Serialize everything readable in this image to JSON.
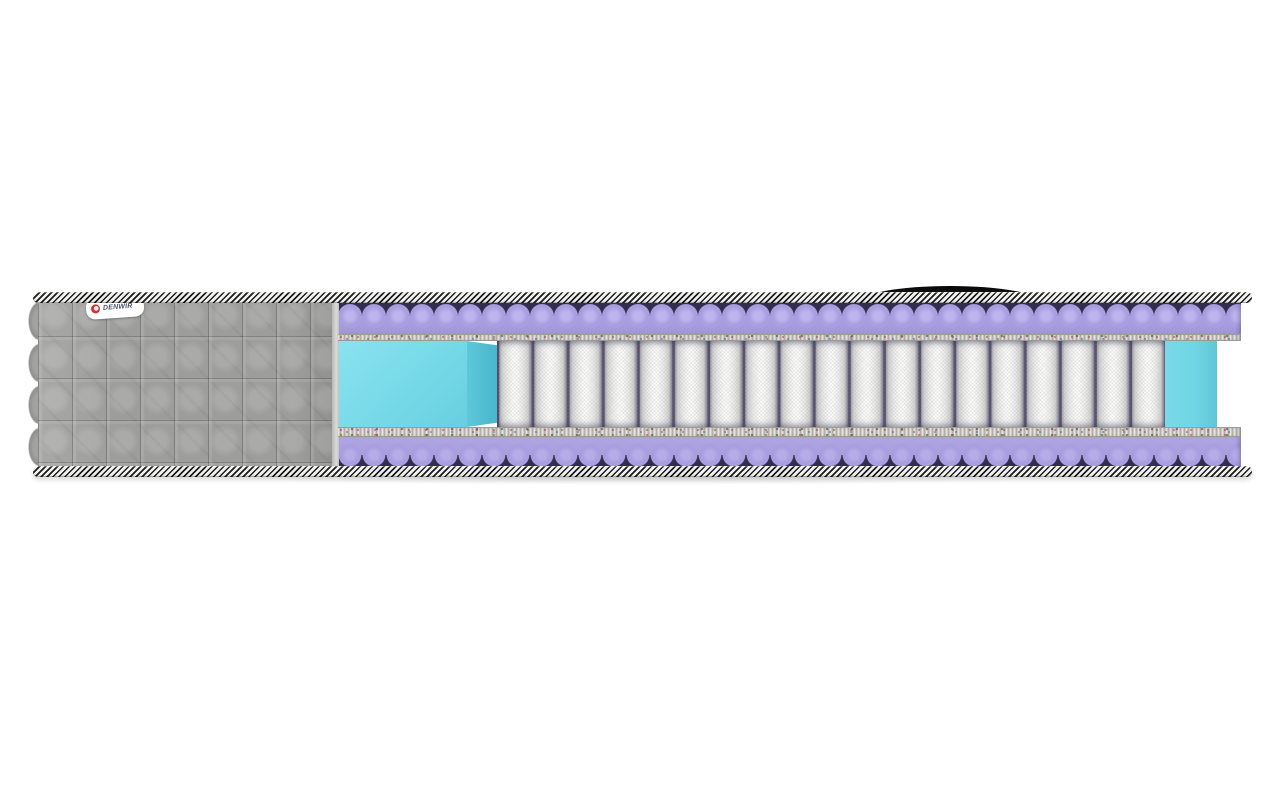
{
  "image": {
    "kind": "product-render",
    "subject": "mattress cross-section cutaway",
    "background_color": "#ffffff"
  },
  "brand": {
    "label": "DENWIR",
    "label_bg": "#ffffff",
    "logo_color": "#d3312e",
    "text_color": "#475069"
  },
  "structure": {
    "spring_count": 19,
    "layers_top_to_bottom": [
      "striped-edge-tape",
      "wave-profile-foam",
      "felt-pad",
      "pocket-spring-block-with-side-support-foam",
      "felt-pad",
      "wave-profile-foam",
      "striped-edge-tape"
    ],
    "left_section": "gray-quilted-cover",
    "accessory": "black-carry-handle"
  },
  "theme": {
    "foam-purple": "#a99fe0",
    "foam-dark": "#332e4e",
    "support-cyan": "#7adbe9",
    "support-cyan-right": "#6fd5e4",
    "cover-gray": "#9fa09e",
    "felt-gray": "#cdc9c4",
    "tape-black": "#1c1c1c",
    "tape-white": "#f2f2f1",
    "label-bg": "#ffffff",
    "logo-red": "#d3312e"
  }
}
